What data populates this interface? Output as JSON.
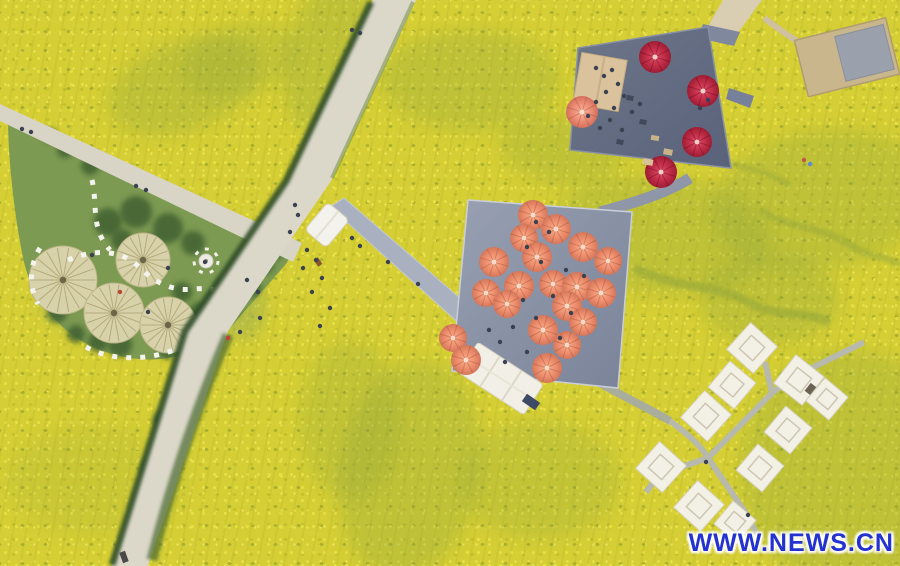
{
  "watermark": {
    "text": "WWW.NEWS.CN",
    "color": "#2433cf"
  },
  "colors": {
    "field_base": "#d5ce34",
    "lawn_green": "#7d9a52",
    "tree_green": "#3f6030",
    "patch_green": "#8da43c",
    "road": "#dbd7c9",
    "hedge": "#31502a",
    "walkway": "#a9b0bf",
    "plaza_deck_light": "#98a0b2",
    "plaza_deck_dark": "#7a8398",
    "platform_deck_light": "#6d7689",
    "platform_deck_dark": "#59627a",
    "umbrella_coral": "#ec8a66",
    "umbrella_red": "#c22e48",
    "umbrella_salmon": "#ee8f78",
    "canopy_tan": "#d9c29c",
    "tent_white": "#f3f0e5",
    "stone_white": "#f4f4ef",
    "straw_circle": "#d8d2ab",
    "person_default": "#3a4150"
  },
  "scene": {
    "green_patches": [
      {
        "x": 185,
        "y": 85,
        "rx": 80,
        "ry": 45,
        "rot": -20,
        "o": 0.3
      },
      {
        "x": 330,
        "y": 55,
        "rx": 45,
        "ry": 80,
        "rot": 15,
        "o": 0.3
      },
      {
        "x": 470,
        "y": 80,
        "rx": 90,
        "ry": 50,
        "rot": 0,
        "o": 0.3
      },
      {
        "x": 560,
        "y": 150,
        "rx": 60,
        "ry": 35,
        "rot": 10,
        "o": 0.28
      },
      {
        "x": 660,
        "y": 235,
        "rx": 110,
        "ry": 60,
        "rot": 5,
        "o": 0.3
      },
      {
        "x": 820,
        "y": 200,
        "rx": 110,
        "ry": 70,
        "rot": -10,
        "o": 0.3
      },
      {
        "x": 410,
        "y": 470,
        "rx": 70,
        "ry": 110,
        "rot": 10,
        "o": 0.3
      },
      {
        "x": 350,
        "y": 420,
        "rx": 50,
        "ry": 80,
        "rot": 0,
        "o": 0.25
      },
      {
        "x": 95,
        "y": 480,
        "rx": 90,
        "ry": 55,
        "rot": 0,
        "o": 0.14
      },
      {
        "x": 850,
        "y": 470,
        "rx": 110,
        "ry": 120,
        "rot": 0,
        "o": 0.3
      },
      {
        "x": 770,
        "y": 300,
        "rx": 70,
        "ry": 45,
        "rot": 0,
        "o": 0.3
      },
      {
        "x": 640,
        "y": 120,
        "rx": 50,
        "ry": 35,
        "rot": 0,
        "o": 0.28
      },
      {
        "x": 540,
        "y": 480,
        "rx": 80,
        "ry": 60,
        "rot": 0,
        "o": 0.24
      },
      {
        "x": 240,
        "y": 60,
        "rx": 60,
        "ry": 35,
        "rot": -15,
        "o": 0.24
      },
      {
        "x": 150,
        "y": 285,
        "rx": 55,
        "ry": 35,
        "rot": 0,
        "o": 0.5,
        "c": "#9cb468"
      },
      {
        "x": 85,
        "y": 300,
        "rx": 45,
        "ry": 28,
        "rot": 0,
        "o": 0.45,
        "c": "#93ad62"
      },
      {
        "x": 235,
        "y": 300,
        "rx": 30,
        "ry": 40,
        "rot": -15,
        "o": 0.4,
        "c": "#8aa65c"
      }
    ],
    "trees": [
      {
        "x": 108,
        "y": 222,
        "r": 14
      },
      {
        "x": 136,
        "y": 212,
        "r": 16
      },
      {
        "x": 168,
        "y": 228,
        "r": 15
      },
      {
        "x": 193,
        "y": 243,
        "r": 12
      },
      {
        "x": 152,
        "y": 246,
        "r": 12
      },
      {
        "x": 122,
        "y": 240,
        "r": 11
      },
      {
        "x": 182,
        "y": 292,
        "r": 10
      },
      {
        "x": 200,
        "y": 313,
        "r": 11
      },
      {
        "x": 192,
        "y": 336,
        "r": 10
      },
      {
        "x": 168,
        "y": 350,
        "r": 9
      },
      {
        "x": 120,
        "y": 345,
        "r": 12
      },
      {
        "x": 98,
        "y": 342,
        "r": 10
      },
      {
        "x": 57,
        "y": 313,
        "r": 10
      },
      {
        "x": 76,
        "y": 334,
        "r": 9
      },
      {
        "x": 214,
        "y": 300,
        "r": 9
      },
      {
        "x": 222,
        "y": 286,
        "r": 8
      },
      {
        "x": 240,
        "y": 272,
        "r": 10
      },
      {
        "x": 252,
        "y": 288,
        "r": 9
      },
      {
        "x": 207,
        "y": 321,
        "r": 8
      },
      {
        "x": 232,
        "y": 310,
        "r": 8
      },
      {
        "x": 265,
        "y": 265,
        "r": 9
      },
      {
        "x": 275,
        "y": 252,
        "r": 8
      },
      {
        "x": 65,
        "y": 150,
        "r": 8
      },
      {
        "x": 90,
        "y": 166,
        "r": 9
      },
      {
        "x": 50,
        "y": 135,
        "r": 7
      },
      {
        "x": 162,
        "y": 420,
        "r": 9
      },
      {
        "x": 150,
        "y": 468,
        "r": 9
      },
      {
        "x": 141,
        "y": 512,
        "r": 8
      }
    ],
    "garden_circles": [
      {
        "x": 63,
        "y": 280,
        "r": 34
      },
      {
        "x": 143,
        "y": 260,
        "r": 27
      },
      {
        "x": 114,
        "y": 313,
        "r": 30
      },
      {
        "x": 168,
        "y": 325,
        "r": 28
      }
    ],
    "plaza_umbrellas": [
      {
        "x": 533,
        "y": 215,
        "r": 15
      },
      {
        "x": 556,
        "y": 229,
        "r": 15
      },
      {
        "x": 524,
        "y": 238,
        "r": 14
      },
      {
        "x": 583,
        "y": 247,
        "r": 15
      },
      {
        "x": 537,
        "y": 257,
        "r": 15
      },
      {
        "x": 608,
        "y": 261,
        "r": 14
      },
      {
        "x": 494,
        "y": 262,
        "r": 15
      },
      {
        "x": 519,
        "y": 286,
        "r": 15
      },
      {
        "x": 553,
        "y": 284,
        "r": 14
      },
      {
        "x": 577,
        "y": 287,
        "r": 15
      },
      {
        "x": 486,
        "y": 293,
        "r": 14
      },
      {
        "x": 601,
        "y": 293,
        "r": 15
      },
      {
        "x": 507,
        "y": 304,
        "r": 14
      },
      {
        "x": 567,
        "y": 306,
        "r": 15
      },
      {
        "x": 583,
        "y": 322,
        "r": 14
      },
      {
        "x": 543,
        "y": 330,
        "r": 15
      },
      {
        "x": 453,
        "y": 338,
        "r": 14
      },
      {
        "x": 567,
        "y": 345,
        "r": 14
      },
      {
        "x": 466,
        "y": 360,
        "r": 15
      },
      {
        "x": 547,
        "y": 368,
        "r": 15
      }
    ],
    "platform_umbrellas": [
      {
        "x": 655,
        "y": 57,
        "r": 16,
        "kind": "red"
      },
      {
        "x": 703,
        "y": 91,
        "r": 16,
        "kind": "red"
      },
      {
        "x": 697,
        "y": 142,
        "r": 15,
        "kind": "red"
      },
      {
        "x": 661,
        "y": 172,
        "r": 16,
        "kind": "red"
      },
      {
        "x": 582,
        "y": 112,
        "r": 16,
        "kind": "salmon"
      }
    ],
    "tents": [
      {
        "x": 752,
        "y": 348,
        "s": 36,
        "rot": 42
      },
      {
        "x": 732,
        "y": 385,
        "s": 34,
        "rot": 40
      },
      {
        "x": 799,
        "y": 380,
        "s": 36,
        "rot": 38,
        "door": true
      },
      {
        "x": 827,
        "y": 399,
        "s": 30,
        "rot": 40
      },
      {
        "x": 706,
        "y": 416,
        "s": 36,
        "rot": 42
      },
      {
        "x": 788,
        "y": 430,
        "s": 34,
        "rot": 40
      },
      {
        "x": 661,
        "y": 467,
        "s": 36,
        "rot": 42
      },
      {
        "x": 760,
        "y": 468,
        "s": 34,
        "rot": 40
      },
      {
        "x": 699,
        "y": 506,
        "s": 36,
        "rot": 42
      },
      {
        "x": 735,
        "y": 522,
        "s": 30,
        "rot": 40
      }
    ],
    "furniture": [
      {
        "x": 531,
        "y": 402,
        "w": 16,
        "h": 9,
        "rot": 35,
        "c": "#3e4a66"
      },
      {
        "x": 630,
        "y": 98,
        "w": 7,
        "h": 5,
        "rot": 10,
        "c": "#414a5c"
      },
      {
        "x": 643,
        "y": 122,
        "w": 7,
        "h": 5,
        "rot": 10,
        "c": "#414a5c"
      },
      {
        "x": 620,
        "y": 142,
        "w": 7,
        "h": 5,
        "rot": 10,
        "c": "#414a5c"
      },
      {
        "x": 655,
        "y": 138,
        "w": 8,
        "h": 5,
        "rot": 10,
        "c": "#c9b288"
      },
      {
        "x": 668,
        "y": 152,
        "w": 9,
        "h": 6,
        "rot": 10,
        "c": "#c9b288"
      },
      {
        "x": 648,
        "y": 162,
        "w": 10,
        "h": 6,
        "rot": 10,
        "c": "#d8c29a"
      },
      {
        "x": 124,
        "y": 557,
        "w": 11,
        "h": 6,
        "rot": 70,
        "c": "#4a4a4a"
      },
      {
        "x": 318,
        "y": 262,
        "w": 8,
        "h": 5,
        "rot": 55,
        "c": "#88552f"
      }
    ],
    "people": [
      [
        352,
        30
      ],
      [
        360,
        33
      ],
      [
        22,
        129
      ],
      [
        31,
        132
      ],
      [
        136,
        186
      ],
      [
        146,
        190
      ],
      [
        295,
        205
      ],
      [
        298,
        215
      ],
      [
        290,
        232
      ],
      [
        307,
        250
      ],
      [
        316,
        260
      ],
      [
        303,
        268
      ],
      [
        322,
        278
      ],
      [
        312,
        292
      ],
      [
        247,
        280
      ],
      [
        258,
        292
      ],
      [
        330,
        308
      ],
      [
        320,
        326
      ],
      [
        228,
        338,
        "#c2403a"
      ],
      [
        352,
        238
      ],
      [
        360,
        246
      ],
      [
        388,
        262
      ],
      [
        418,
        284
      ],
      [
        260,
        318
      ],
      [
        240,
        332
      ],
      [
        536,
        222
      ],
      [
        549,
        232
      ],
      [
        527,
        247
      ],
      [
        541,
        262
      ],
      [
        566,
        270
      ],
      [
        584,
        276
      ],
      [
        553,
        296
      ],
      [
        523,
        300
      ],
      [
        571,
        313
      ],
      [
        536,
        318
      ],
      [
        513,
        327
      ],
      [
        560,
        338
      ],
      [
        500,
        342
      ],
      [
        527,
        352
      ],
      [
        505,
        362
      ],
      [
        489,
        330
      ],
      [
        596,
        68
      ],
      [
        604,
        76
      ],
      [
        612,
        70
      ],
      [
        618,
        84
      ],
      [
        606,
        92
      ],
      [
        596,
        102
      ],
      [
        614,
        108
      ],
      [
        624,
        96
      ],
      [
        632,
        112
      ],
      [
        610,
        120
      ],
      [
        600,
        128
      ],
      [
        622,
        130
      ],
      [
        588,
        116
      ],
      [
        640,
        104
      ],
      [
        700,
        108
      ],
      [
        708,
        100
      ],
      [
        120,
        292,
        "#b8452f"
      ],
      [
        148,
        312
      ],
      [
        205,
        262
      ],
      [
        92,
        255
      ],
      [
        168,
        268
      ],
      [
        810,
        164,
        "#5b8bd6"
      ],
      [
        804,
        160,
        "#c0574a"
      ],
      [
        706,
        462
      ],
      [
        748,
        515
      ]
    ]
  }
}
